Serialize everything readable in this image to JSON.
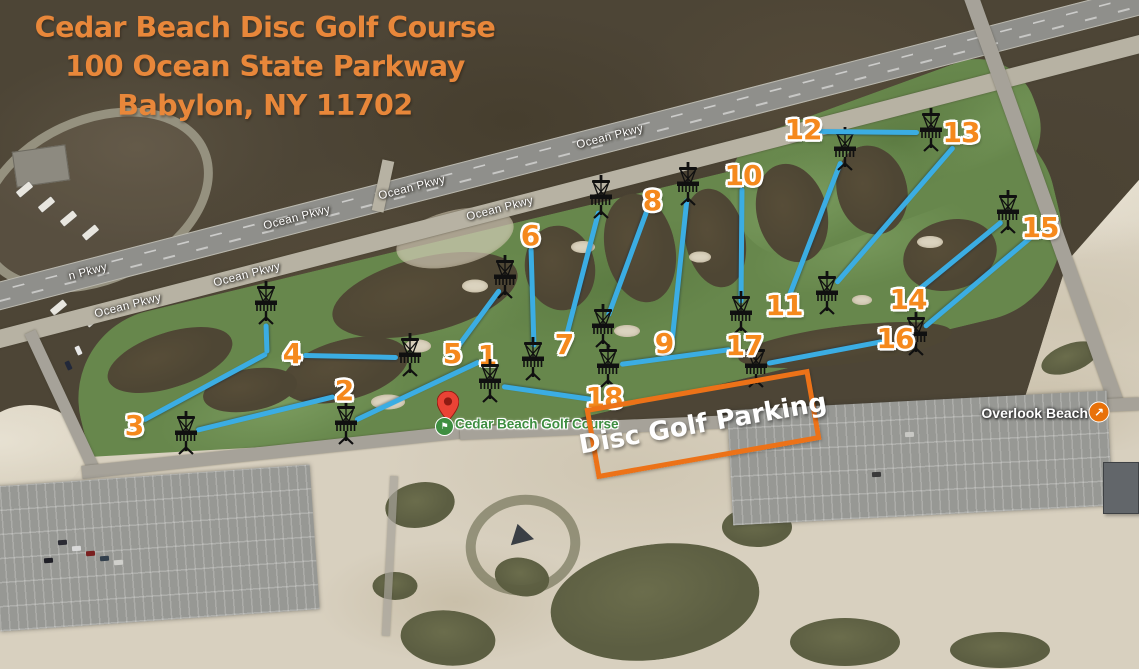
{
  "map": {
    "width": 1139,
    "height": 669
  },
  "colors": {
    "line": "#3BADE3",
    "num": "#F5891D",
    "title": "#E8873A",
    "box": "#EC7218",
    "poi": "#3E8E41"
  },
  "title": {
    "lines": [
      "Cedar Beach Disc Golf Course",
      "100 Ocean State Parkway",
      "Babylon, NY 11702"
    ]
  },
  "parking_sign": {
    "label": "Disc Golf Parking",
    "center": [
      703,
      424
    ],
    "size": [
      218,
      62
    ],
    "rotation": -10
  },
  "course_marker": {
    "label": "Cedar Beach Golf Course",
    "pin_xy": [
      448,
      421
    ],
    "dot_xy": [
      443,
      425
    ],
    "label_xy": [
      455,
      424
    ]
  },
  "beach_marker": {
    "label": "Overlook Beach",
    "label_xy": [
      1088,
      413
    ],
    "icon_xy": [
      1099,
      412
    ]
  },
  "road_labels": [
    {
      "text": "n Pkwy",
      "x": 88,
      "y": 272
    },
    {
      "text": "Ocean Pkwy",
      "x": 128,
      "y": 306
    },
    {
      "text": "Ocean Pkwy",
      "x": 247,
      "y": 275
    },
    {
      "text": "Ocean Pkwy",
      "x": 297,
      "y": 218
    },
    {
      "text": "Ocean Pkwy",
      "x": 412,
      "y": 188
    },
    {
      "text": "Ocean Pkwy",
      "x": 500,
      "y": 209
    },
    {
      "text": "Ocean Pkwy",
      "x": 610,
      "y": 137
    }
  ],
  "holes": [
    {
      "n": "1",
      "label_xy": [
        487,
        356
      ],
      "path": [
        [
          480,
          361
        ],
        [
          355,
          420
        ]
      ],
      "basket_xy": [
        346,
        423
      ]
    },
    {
      "n": "2",
      "label_xy": [
        344,
        391
      ],
      "path": [
        [
          335,
          396
        ],
        [
          196,
          430
        ]
      ],
      "basket_xy": [
        186,
        433
      ]
    },
    {
      "n": "3",
      "label_xy": [
        134,
        426
      ],
      "path": [
        [
          143,
          420
        ],
        [
          267,
          353
        ],
        [
          266,
          323
        ]
      ],
      "basket_xy": [
        266,
        303
      ]
    },
    {
      "n": "4",
      "label_xy": [
        292,
        354
      ],
      "path": [
        [
          303,
          355
        ],
        [
          398,
          357
        ]
      ],
      "basket_xy": [
        410,
        355
      ]
    },
    {
      "n": "5",
      "label_xy": [
        452,
        354
      ],
      "path": [
        [
          458,
          346
        ],
        [
          500,
          289
        ]
      ],
      "basket_xy": [
        505,
        277
      ]
    },
    {
      "n": "6",
      "label_xy": [
        530,
        236
      ],
      "path": [
        [
          531,
          247
        ],
        [
          534,
          347
        ]
      ],
      "basket_xy": [
        533,
        359
      ]
    },
    {
      "n": "7",
      "label_xy": [
        564,
        345
      ],
      "path": [
        [
          566,
          337
        ],
        [
          599,
          210
        ]
      ],
      "basket_xy": [
        601,
        197
      ]
    },
    {
      "n": "8",
      "label_xy": [
        652,
        201
      ],
      "path": [
        [
          647,
          210
        ],
        [
          608,
          316
        ]
      ],
      "basket_xy": [
        603,
        326
      ]
    },
    {
      "n": "9",
      "label_xy": [
        664,
        344
      ],
      "path": [
        [
          671,
          351
        ],
        [
          687,
          198
        ]
      ],
      "basket_xy": [
        688,
        184
      ]
    },
    {
      "n": "10",
      "label_xy": [
        743,
        176
      ],
      "path": [
        [
          742,
          187
        ],
        [
          741,
          303
        ]
      ],
      "basket_xy": [
        741,
        313
      ]
    },
    {
      "n": "11",
      "label_xy": [
        784,
        306
      ],
      "path": [
        [
          789,
          296
        ],
        [
          841,
          161
        ]
      ],
      "basket_xy": [
        845,
        149
      ]
    },
    {
      "n": "12",
      "label_xy": [
        803,
        130
      ],
      "path": [
        [
          816,
          131
        ],
        [
          919,
          132
        ]
      ],
      "basket_xy": [
        931,
        130
      ]
    },
    {
      "n": "13",
      "label_xy": [
        961,
        133
      ],
      "path": [
        [
          954,
          146
        ],
        [
          836,
          283
        ]
      ],
      "basket_xy": [
        827,
        293
      ]
    },
    {
      "n": "14",
      "label_xy": [
        908,
        300
      ],
      "path": [
        [
          914,
          293
        ],
        [
          1002,
          221
        ]
      ],
      "basket_xy": [
        1008,
        212
      ]
    },
    {
      "n": "15",
      "label_xy": [
        1040,
        228
      ],
      "path": [
        [
          1032,
          236
        ],
        [
          924,
          327
        ]
      ],
      "basket_xy": [
        916,
        334
      ]
    },
    {
      "n": "16",
      "label_xy": [
        895,
        339
      ],
      "path": [
        [
          883,
          341
        ],
        [
          767,
          363
        ]
      ],
      "basket_xy": [
        756,
        366
      ]
    },
    {
      "n": "17",
      "label_xy": [
        744,
        346
      ],
      "path": [
        [
          731,
          349
        ],
        [
          620,
          364
        ]
      ],
      "basket_xy": [
        608,
        366
      ]
    },
    {
      "n": "18",
      "label_xy": [
        604,
        398
      ],
      "path": [
        [
          592,
          399
        ],
        [
          502,
          386
        ]
      ],
      "basket_xy": [
        490,
        381
      ]
    }
  ]
}
